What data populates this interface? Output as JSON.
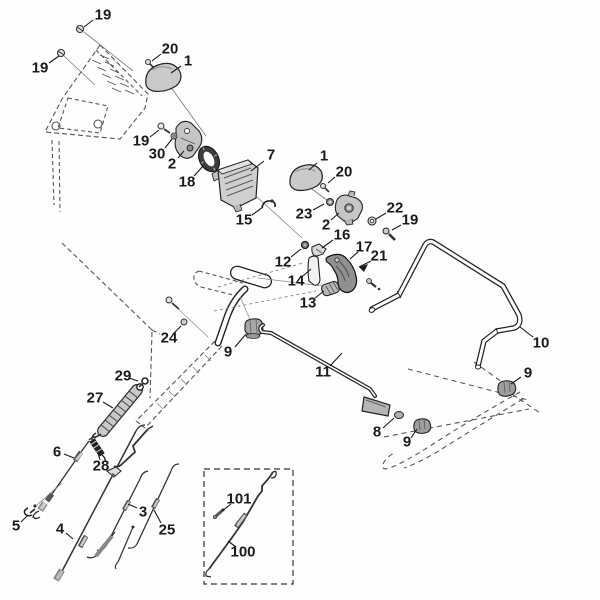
{
  "figure": {
    "kind": "exploded-parts-diagram",
    "background": "#fefefe",
    "label_color": "#1a1a1a",
    "label_font_size": 15,
    "leader_color": "#1a1a1a",
    "part_color_light": "#cccccc",
    "part_color_dark": "#8f8f8f"
  },
  "part_labels": [
    {
      "text": "19",
      "x": 103,
      "y": 15,
      "leader": [
        93,
        20,
        84,
        27
      ]
    },
    {
      "text": "20",
      "x": 170,
      "y": 49,
      "leader": [
        161,
        54,
        152,
        61
      ]
    },
    {
      "text": "1",
      "x": 188,
      "y": 61,
      "leader": [
        181,
        66,
        171,
        73
      ]
    },
    {
      "text": "19",
      "x": 40,
      "y": 68,
      "leader": [
        49,
        63,
        59,
        56
      ]
    },
    {
      "text": "19",
      "x": 141,
      "y": 141,
      "leader": [
        150,
        137,
        159,
        130
      ]
    },
    {
      "text": "30",
      "x": 157,
      "y": 154,
      "leader": [
        165,
        148,
        172,
        139
      ]
    },
    {
      "text": "2",
      "x": 172,
      "y": 164,
      "leader": [
        178,
        158,
        184,
        151
      ]
    },
    {
      "text": "18",
      "x": 187,
      "y": 182,
      "leader": [
        194,
        176,
        203,
        166
      ]
    },
    {
      "text": "7",
      "x": 271,
      "y": 155,
      "leader": [
        264,
        161,
        251,
        171
      ]
    },
    {
      "text": "15",
      "x": 244,
      "y": 220,
      "leader": [
        252,
        215,
        263,
        207
      ]
    },
    {
      "text": "1",
      "x": 324,
      "y": 156,
      "leader": [
        317,
        163,
        309,
        170
      ]
    },
    {
      "text": "20",
      "x": 344,
      "y": 172,
      "leader": [
        335,
        177,
        328,
        183
      ]
    },
    {
      "text": "23",
      "x": 304,
      "y": 214,
      "leader": [
        313,
        210,
        324,
        204
      ]
    },
    {
      "text": "2",
      "x": 326,
      "y": 225,
      "leader": [
        331,
        220,
        339,
        213
      ]
    },
    {
      "text": "22",
      "x": 395,
      "y": 208,
      "leader": [
        386,
        213,
        376,
        219
      ]
    },
    {
      "text": "19",
      "x": 410,
      "y": 220,
      "leader": [
        401,
        225,
        392,
        230
      ]
    },
    {
      "text": "16",
      "x": 342,
      "y": 235,
      "leader": [
        333,
        240,
        322,
        248
      ]
    },
    {
      "text": "12",
      "x": 283,
      "y": 262,
      "leader": [
        291,
        257,
        301,
        249
      ]
    },
    {
      "text": "17",
      "x": 364,
      "y": 247,
      "leader": [
        358,
        252,
        350,
        259
      ]
    },
    {
      "text": "21",
      "x": 379,
      "y": 256,
      "leader": [
        371,
        261,
        359,
        267
      ],
      "arrow": true
    },
    {
      "text": "14",
      "x": 296,
      "y": 281,
      "leader": [
        303,
        276,
        311,
        269
      ]
    },
    {
      "text": "13",
      "x": 308,
      "y": 303,
      "leader": [
        315,
        298,
        324,
        291
      ]
    },
    {
      "text": "10",
      "x": 541,
      "y": 343,
      "leader": [
        533,
        337,
        520,
        327
      ]
    },
    {
      "text": "9",
      "x": 528,
      "y": 373,
      "leader": [
        521,
        377,
        511,
        384
      ]
    },
    {
      "text": "24",
      "x": 169,
      "y": 338,
      "leader": [
        174,
        333,
        181,
        326
      ]
    },
    {
      "text": "9",
      "x": 228,
      "y": 352,
      "leader": [
        235,
        347,
        246,
        334
      ]
    },
    {
      "text": "11",
      "x": 323,
      "y": 372,
      "leader": [
        330,
        366,
        342,
        353
      ]
    },
    {
      "text": "29",
      "x": 123,
      "y": 376,
      "leader": [
        129,
        378,
        138,
        381
      ]
    },
    {
      "text": "27",
      "x": 95,
      "y": 398,
      "leader": [
        103,
        402,
        113,
        408
      ]
    },
    {
      "text": "8",
      "x": 377,
      "y": 432,
      "leader": [
        383,
        428,
        394,
        418
      ]
    },
    {
      "text": "9",
      "x": 407,
      "y": 442,
      "leader": [
        411,
        438,
        417,
        429
      ]
    },
    {
      "text": "6",
      "x": 57,
      "y": 452,
      "leader": [
        64,
        454,
        74,
        458
      ]
    },
    {
      "text": "28",
      "x": 101,
      "y": 466,
      "leader": [
        100,
        460,
        98,
        453
      ]
    },
    {
      "text": "5",
      "x": 16,
      "y": 526,
      "leader": [
        21,
        522,
        28,
        515
      ]
    },
    {
      "text": "4",
      "x": 60,
      "y": 529,
      "leader": [
        66,
        533,
        73,
        539
      ]
    },
    {
      "text": "3",
      "x": 143,
      "y": 512,
      "leader": [
        137,
        508,
        128,
        504
      ]
    },
    {
      "text": "25",
      "x": 167,
      "y": 530,
      "leader": [
        161,
        523,
        154,
        510
      ]
    },
    {
      "text": "101",
      "x": 239,
      "y": 499,
      "leader": [
        231,
        504,
        222,
        511
      ]
    },
    {
      "text": "100",
      "x": 243,
      "y": 552,
      "leader": [
        236,
        547,
        228,
        541
      ]
    }
  ]
}
